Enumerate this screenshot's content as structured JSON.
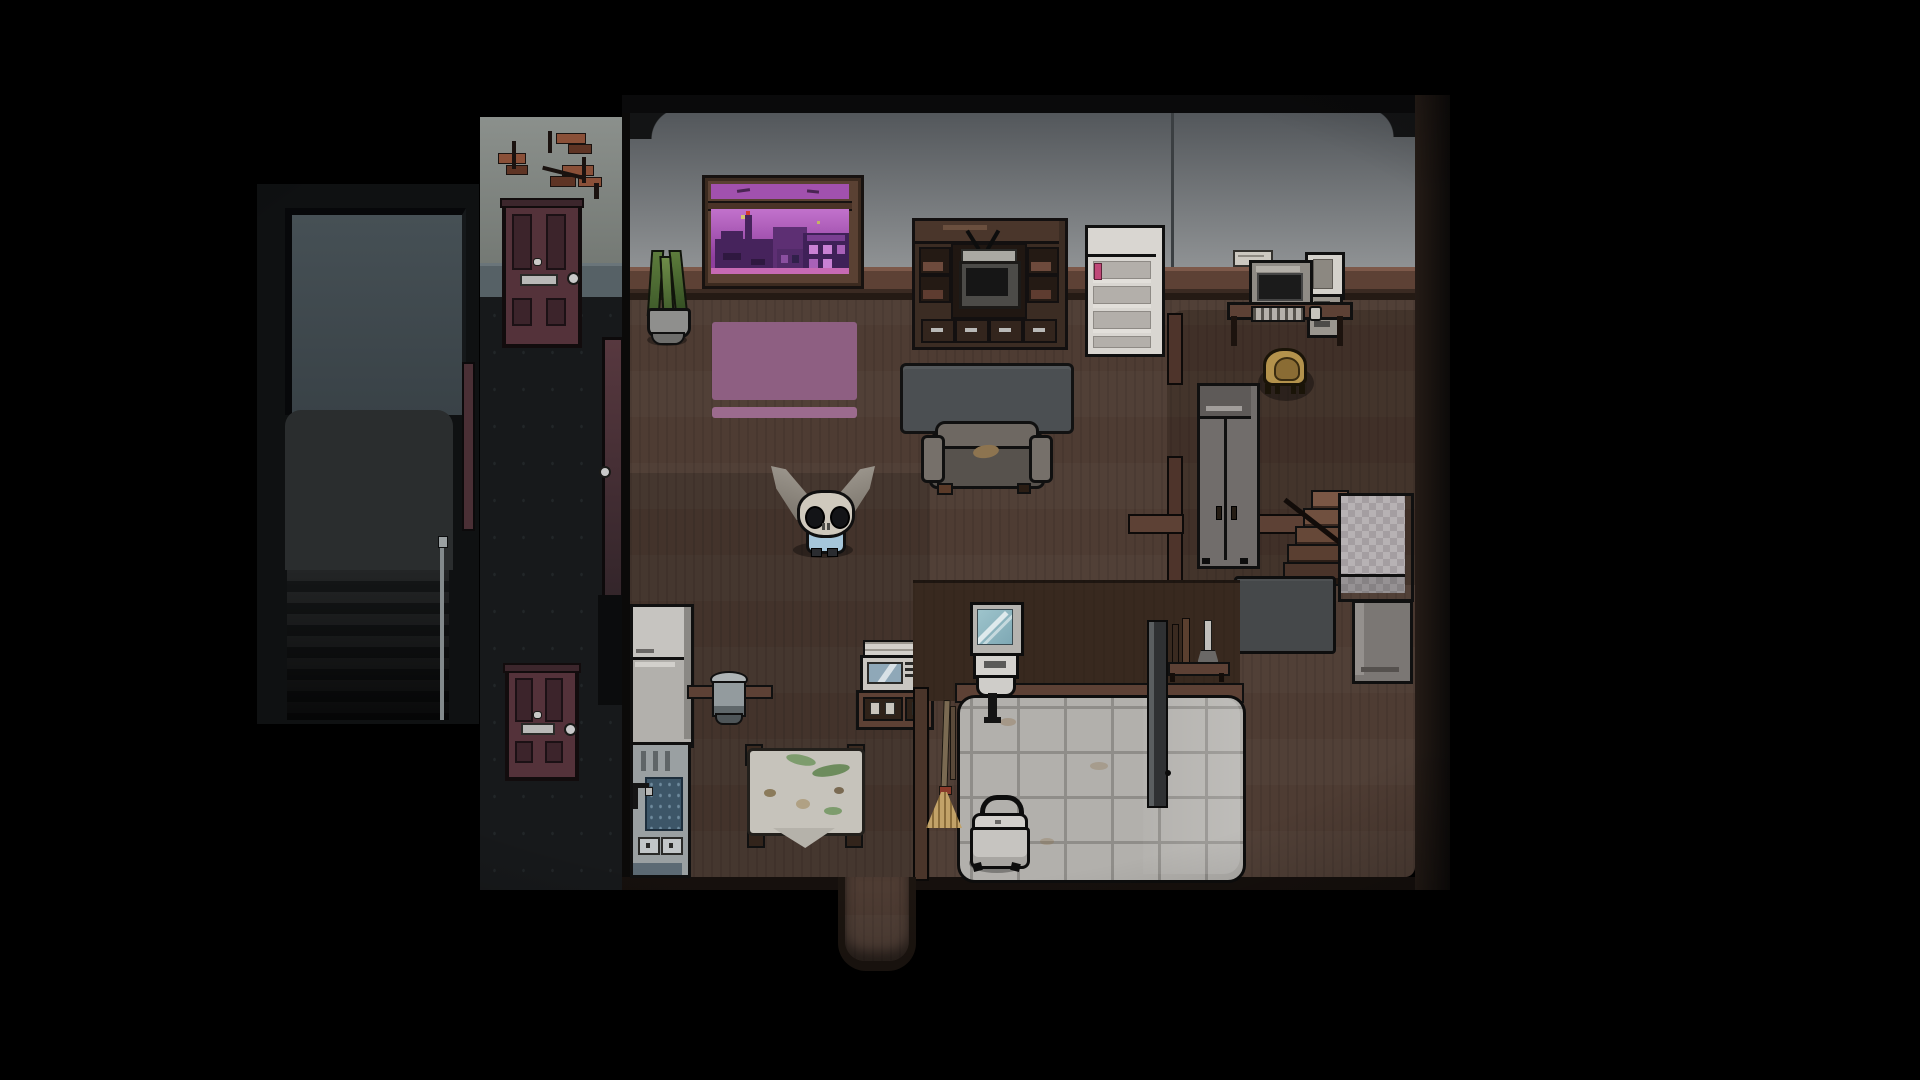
{
  "app": {
    "name": "pixel-rpg",
    "view": "apartment-interior-night",
    "resolution": "1920x1080",
    "visible_text": "none"
  },
  "scene": {
    "description": "Top-down pixel-art view of a dim one-room apartment at night: living area with couch and TV console, purple city window, kitchen with stained table, bathroom with tiled floor, bedroom alcove with wardrobe and checkered bed; a hallway with maroon doors and a dark stairwell sit outside to the left. A small skull-headed creature with long gray ears and a blue outfit stands on the wood floor.",
    "player": {
      "name": "skull-eared-creature",
      "head_color": "#cfc9bd",
      "ear_color": "#a39d94",
      "outfit_color": "#a6c6da",
      "state": "standing-facing-down"
    },
    "rooms": [
      {
        "name": "stairwell",
        "features": [
          "wall-panel",
          "landing-floor",
          "descending-stairs",
          "handrail"
        ]
      },
      {
        "name": "hallway",
        "features": [
          "damaged-brick-wall",
          "wainscot",
          "upper-door",
          "lower-door",
          "apartment-door"
        ]
      },
      {
        "name": "living-room",
        "features": [
          "city-window",
          "potted-plant",
          "pink-rug",
          "tv-console",
          "crt-tv",
          "white-shelf",
          "slate-table",
          "couch"
        ]
      },
      {
        "name": "study-alcove",
        "features": [
          "computer-desk",
          "crt-monitor",
          "pc-tower",
          "picture-frame",
          "wicker-chair",
          "partition-walls"
        ]
      },
      {
        "name": "bedroom-nook",
        "features": [
          "wardrobe",
          "stairs-down",
          "checkered-bed",
          "foot-chest",
          "slate-panel"
        ]
      },
      {
        "name": "kitchen",
        "features": [
          "fridge",
          "sink-unit",
          "stock-pot",
          "ledge",
          "cloth-table",
          "cabinet-counter",
          "microwave",
          "broom"
        ]
      },
      {
        "name": "bathroom",
        "features": [
          "mirror",
          "wall-sink",
          "tiled-floor",
          "folding-divider",
          "plunger-stand",
          "lidded-basket",
          "entry-stub"
        ]
      }
    ],
    "objects": [
      {
        "name": "city-window",
        "detail": "purple dusk skyline with factory smokestack, red beacon, lit building windows, stars, birds"
      },
      {
        "name": "crt-tv",
        "detail": "rabbit-ear antenna, dark screen"
      },
      {
        "name": "couch",
        "detail": "worn gray couch with brown stain"
      },
      {
        "name": "bed",
        "detail": "gray checkered blanket"
      },
      {
        "name": "kitchen-table",
        "detail": "white tablecloth with green and brown stains"
      },
      {
        "name": "laundry-basket",
        "detail": "white lidded basket with carry handle"
      }
    ],
    "time_of_day": "night",
    "lighting": "dark vignette around edges"
  },
  "palette": {
    "bg": "#000000",
    "outer_dark": "#0a0a0b",
    "stairwell_bg": "#0f1112",
    "stairwell_wall": "#465055",
    "stairwell_wall_dark": "#394247",
    "stairwell_floor": "#2a2d2e",
    "stair_step": "#232526",
    "stair_step_dark": "#141617",
    "stair_rail": "#838a8c",
    "hall_wall": "#8b908c",
    "hall_wall_dark": "#6f746f",
    "brick": "#8a5038",
    "brick_dark": "#5e3424",
    "crack": "#1a120f",
    "wainscot": "#566166",
    "wainscot_dark": "#2c3337",
    "hall_floor": "#17191b",
    "door_red": "#54323a",
    "door_panel": "#3c242b",
    "door_outline": "#120c0d",
    "knob_silver": "#c9c9c9",
    "apt_wall": "#8f9294",
    "apt_wall_top": "#53575b",
    "rail_light": "#7d594a",
    "rail_mid": "#5d4135",
    "rail_dark": "#241a14",
    "floor_wood": "#4e3c33",
    "wall_brown": "#38291f",
    "window_frame": "#5a4133",
    "sky_purple": "#b565c2",
    "sky_deep": "#8f3f9e",
    "sky_transom": "#a151ae",
    "city_dark": "#46235c",
    "city_mid": "#5d2f73",
    "city_window": "#c981d4",
    "star": "#d6c46e",
    "antenna_red": "#d23a2e",
    "wood_dark": "#2e211a",
    "wood_mid": "#4a362b",
    "wood_light": "#6a4f3e",
    "tv_silver": "#aaa9a3",
    "screen_black": "#161616",
    "shelf_white": "#d9d6d1",
    "shelf_shadow": "#b3afaa",
    "pink_item": "#c04878",
    "couch_gray": "#6e6862",
    "couch_seat": "#57524d",
    "couch_stain": "#8d7450",
    "table_slate": "#4b4f52",
    "wardrobe_gray": "#716d6b",
    "wardrobe_light": "#a19d9a",
    "chair_tan": "#b3924c",
    "chair_tan_dark": "#8a6c34",
    "checker_a": "#b7b2b4",
    "checker_b": "#a49ea1",
    "chest_gray": "#7b7774",
    "panel_slate": "#45484a",
    "fridge_top": "#c6c4c0",
    "fridge_bottom": "#b2b0ac",
    "steel": "#9aa0a2",
    "water": "#3d5668",
    "cloth": "#c6c3bb",
    "stain_green": "#7d9c6d",
    "stain_brown": "#8b7b5b",
    "micro_white": "#d3d0cb",
    "micro_window": "#8fa8b8",
    "tile": "#b2b0ac",
    "grout": "#8f8d89",
    "divider": "#2f3133",
    "basket": "#c6c4c0",
    "plant": "#5d7c3c",
    "plant_dark": "#3e5a2a",
    "pot": "#8f8f8d",
    "bone": "#cfc9bd",
    "eye_dark": "#131417",
    "ear_gray": "#a39d94",
    "ear_shadow": "#756f66",
    "outfit_blue": "#a6c6da",
    "outline": "#101010",
    "rug_pink": "#8e5f82",
    "rug_pink_light": "#9c6b8e",
    "paper": "#ccc8c0"
  }
}
